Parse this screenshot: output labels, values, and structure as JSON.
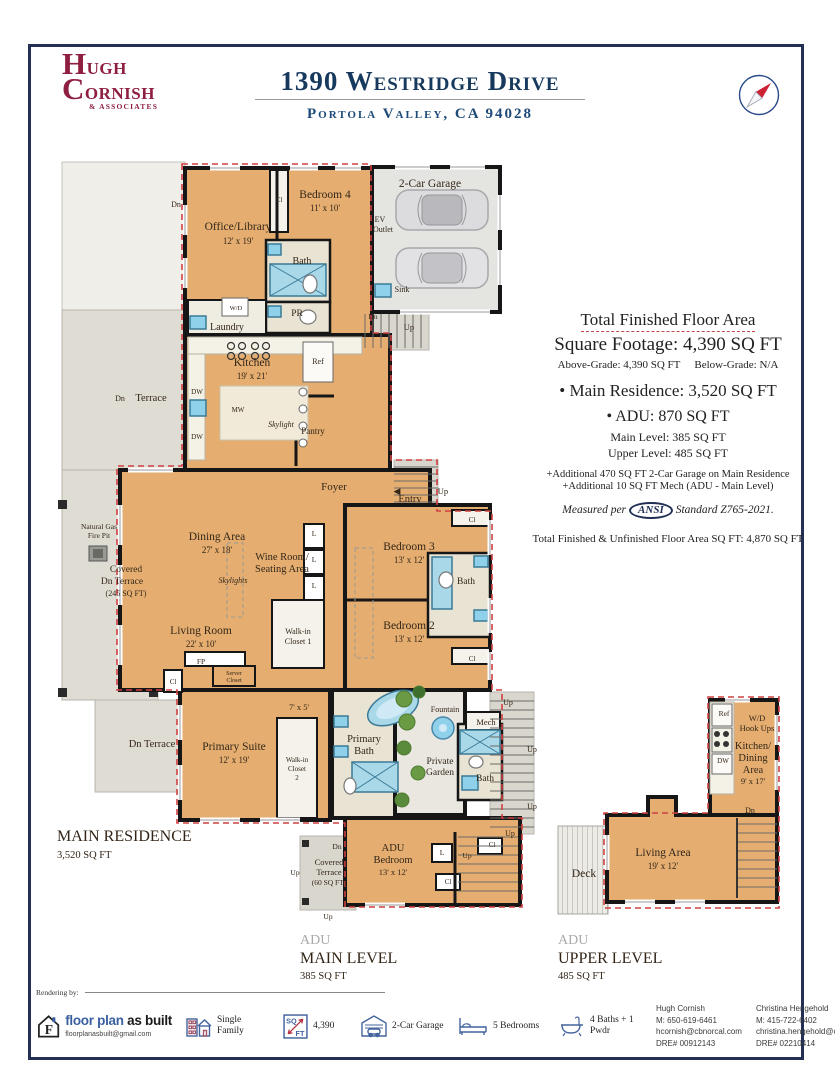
{
  "header": {
    "logo_line1": "HUGH",
    "logo_line2": "CORNISH",
    "logo_line3": "& ASSOCIATES",
    "address": "1390 Westridge Drive",
    "city": "Portola Valley, CA 94028"
  },
  "accent_colors": {
    "navy": "#17395e",
    "maroon": "#8e1f40",
    "red_dash": "#cf4040",
    "floor_tan": "#e5ae70"
  },
  "sqft_block": {
    "total_title": "Total Finished Floor Area",
    "total_sqft": "Square Footage: 4,390 SQ FT",
    "above": "Above-Grade: 4,390 SQ FT",
    "below": "Below-Grade: N/A",
    "main_res": "• Main Residence: 3,520 SQ FT",
    "adu": "• ADU: 870 SQ FT",
    "adu_main": "Main Level: 385 SQ FT",
    "adu_upper": "Upper Level: 485 SQ FT",
    "add1": "+Additional 470 SQ FT 2-Car Garage on Main Residence",
    "add2": "+Additional 10 SQ FT Mech (ADU - Main Level)",
    "measured_pre": "Measured per",
    "ansi": "ANSI",
    "measured_post": "Standard Z765-2021.",
    "total_unfinished": "Total Finished & Unfinished Floor Area SQ FT: 4,870 SQ FT"
  },
  "footer": {
    "rendering_by": "Rendering by:",
    "logo": {
      "brand_blue": "floor plan",
      "brand_black": " as built",
      "email": "floorplanasbuilt@gmail.com"
    },
    "stats": [
      {
        "icon": "building-icon",
        "label": "Single Family"
      },
      {
        "icon": "sqft-icon",
        "label": "4,390"
      },
      {
        "icon": "garage-icon",
        "label": "2-Car Garage"
      },
      {
        "icon": "bed-icon",
        "label": "5 Bedrooms"
      },
      {
        "icon": "bath-icon",
        "label": "4 Baths + 1 Pwdr"
      }
    ],
    "agents": [
      {
        "name": "Hugh Cornish",
        "mobile": "M: 650-619-6461",
        "email": "hcornish@cbnorcal.com",
        "dre": "DRE# 00912143"
      },
      {
        "name": "Christina Hengehold",
        "mobile": "M: 415-722-6402",
        "email": "christina.hengehold@cbrealty.com",
        "dre": "DRE# 02210414"
      }
    ]
  },
  "plan": {
    "texts": [
      {
        "t": "Dn",
        "x": 176,
        "y": 207,
        "s": 8,
        "n": "dn-label-top-left"
      },
      {
        "t": "Office/Library",
        "x": 238,
        "y": 230,
        "s": 11.5,
        "n": "room-office-library"
      },
      {
        "t": "12' x 19'",
        "x": 238,
        "y": 244,
        "s": 9,
        "n": "room-office-dims"
      },
      {
        "t": "Bedroom 4",
        "x": 325,
        "y": 198,
        "s": 11.5,
        "n": "room-bedroom4"
      },
      {
        "t": "11' x 10'",
        "x": 325,
        "y": 211,
        "s": 9,
        "n": "room-bedroom4-dims"
      },
      {
        "t": "Cl",
        "x": 279,
        "y": 202,
        "s": 7,
        "n": "closet-bedroom4"
      },
      {
        "t": "Bath",
        "x": 302,
        "y": 264,
        "s": 10,
        "n": "room-bath-top"
      },
      {
        "t": "PR",
        "x": 297,
        "y": 316,
        "s": 9.5,
        "n": "room-pr"
      },
      {
        "t": "W/D",
        "x": 236,
        "y": 310,
        "s": 6.5,
        "n": "wd-label"
      },
      {
        "t": "Laundry",
        "x": 227,
        "y": 330,
        "s": 10,
        "n": "room-laundry"
      },
      {
        "t": "2-Car Garage",
        "x": 430,
        "y": 187,
        "s": 11.5,
        "n": "room-garage"
      },
      {
        "t": "EV",
        "x": 380,
        "y": 222,
        "s": 8,
        "n": "ev-outlet-1"
      },
      {
        "t": "Outlet",
        "x": 383,
        "y": 232,
        "s": 8,
        "n": "ev-outlet-2"
      },
      {
        "t": "Sink",
        "x": 402,
        "y": 292,
        "s": 8,
        "n": "sink-garage-label"
      },
      {
        "t": "Dn",
        "x": 373,
        "y": 319,
        "s": 7.5,
        "n": "dn-garage"
      },
      {
        "t": "Up",
        "x": 409,
        "y": 330,
        "s": 8.5,
        "n": "up-garage"
      },
      {
        "t": "Kitchen",
        "x": 252,
        "y": 366,
        "s": 11.5,
        "n": "room-kitchen"
      },
      {
        "t": "19' x 21'",
        "x": 252,
        "y": 379,
        "s": 9,
        "n": "room-kitchen-dims"
      },
      {
        "t": "Ref",
        "x": 318,
        "y": 364,
        "s": 8,
        "n": "ref-kitchen"
      },
      {
        "t": "DW",
        "x": 197,
        "y": 394,
        "s": 7,
        "n": "dw-1"
      },
      {
        "t": "MW",
        "x": 238,
        "y": 412,
        "s": 7,
        "n": "mw-label"
      },
      {
        "t": "DW",
        "x": 197,
        "y": 439,
        "s": 7,
        "n": "dw-2"
      },
      {
        "t": "Skylight",
        "x": 281,
        "y": 427,
        "s": 8,
        "i": 1,
        "n": "skylight-kitchen"
      },
      {
        "t": "Pantry",
        "x": 313,
        "y": 434,
        "s": 9,
        "n": "room-pantry"
      },
      {
        "t": "Dn",
        "x": 120,
        "y": 401,
        "s": 8,
        "n": "dn-terrace-mid"
      },
      {
        "t": "Terrace",
        "x": 151,
        "y": 401,
        "s": 10.5,
        "n": "terrace-mid"
      },
      {
        "t": "Foyer",
        "x": 334,
        "y": 490,
        "s": 11,
        "n": "room-foyer"
      },
      {
        "t": "◀",
        "x": 397,
        "y": 494,
        "s": 9,
        "n": "entry-arrow"
      },
      {
        "t": "Entry",
        "x": 410,
        "y": 502,
        "s": 10.5,
        "n": "entry-label"
      },
      {
        "t": "Up",
        "x": 443,
        "y": 494,
        "s": 8.5,
        "n": "up-entry"
      },
      {
        "t": "Dining Area",
        "x": 217,
        "y": 540,
        "s": 11.5,
        "n": "room-dining"
      },
      {
        "t": "27' x 18'",
        "x": 217,
        "y": 553,
        "s": 9,
        "n": "room-dining-dims"
      },
      {
        "t": "Wine Room/",
        "x": 282,
        "y": 560,
        "s": 10.5,
        "n": "room-wine-1"
      },
      {
        "t": "Seating Area",
        "x": 282,
        "y": 572,
        "s": 10.5,
        "n": "room-wine-2"
      },
      {
        "t": "Skylights",
        "x": 233,
        "y": 583,
        "s": 8,
        "i": 1,
        "n": "skylights-dining"
      },
      {
        "t": "Living Room",
        "x": 201,
        "y": 634,
        "s": 11.5,
        "n": "room-living"
      },
      {
        "t": "22' x 10'",
        "x": 201,
        "y": 647,
        "s": 9,
        "n": "room-living-dims"
      },
      {
        "t": "FP",
        "x": 201,
        "y": 664,
        "s": 7.5,
        "n": "fp-label"
      },
      {
        "t": "Cl",
        "x": 173,
        "y": 684,
        "s": 7,
        "n": "closet-living"
      },
      {
        "t": "Server",
        "x": 234,
        "y": 675,
        "s": 6,
        "n": "server-closet-1"
      },
      {
        "t": "Closet",
        "x": 234,
        "y": 682,
        "s": 6,
        "n": "server-closet-2"
      },
      {
        "t": "Walk-in",
        "x": 298,
        "y": 634,
        "s": 8,
        "n": "walkin1-1"
      },
      {
        "t": "Closet 1",
        "x": 298,
        "y": 644,
        "s": 8,
        "n": "walkin1-2"
      },
      {
        "t": "L",
        "x": 314,
        "y": 536,
        "s": 7.5,
        "n": "linen-1"
      },
      {
        "t": "L",
        "x": 314,
        "y": 562,
        "s": 7.5,
        "n": "linen-2"
      },
      {
        "t": "L",
        "x": 314,
        "y": 588,
        "s": 7.5,
        "n": "linen-3"
      },
      {
        "t": "Bedroom 3",
        "x": 409,
        "y": 550,
        "s": 11.5,
        "n": "room-bedroom3"
      },
      {
        "t": "13' x 12'",
        "x": 409,
        "y": 563,
        "s": 9,
        "n": "room-bedroom3-dims"
      },
      {
        "t": "Bedroom 2",
        "x": 409,
        "y": 629,
        "s": 11.5,
        "n": "room-bedroom2"
      },
      {
        "t": "13' x 12'",
        "x": 409,
        "y": 642,
        "s": 9,
        "n": "room-bedroom2-dims"
      },
      {
        "t": "Bath",
        "x": 466,
        "y": 584,
        "s": 9.5,
        "n": "room-bath-beds"
      },
      {
        "t": "Cl",
        "x": 472,
        "y": 522,
        "s": 7,
        "n": "closet-bed3"
      },
      {
        "t": "Cl",
        "x": 472,
        "y": 661,
        "s": 7,
        "n": "closet-bed2"
      },
      {
        "t": "Natural Gas",
        "x": 99,
        "y": 529,
        "s": 7.5,
        "n": "firepit-1"
      },
      {
        "t": "Fire Pit",
        "x": 99,
        "y": 538,
        "s": 7.5,
        "n": "firepit-2"
      },
      {
        "t": "Covered",
        "x": 126,
        "y": 572,
        "s": 9.5,
        "n": "covered-terrace-1"
      },
      {
        "t": "Dn Terrace",
        "x": 122,
        "y": 584,
        "s": 9.5,
        "n": "covered-terrace-2"
      },
      {
        "t": "(245 SQ FT)",
        "x": 126,
        "y": 596,
        "s": 8,
        "n": "covered-terrace-3"
      },
      {
        "t": "Primary Suite",
        "x": 234,
        "y": 750,
        "s": 11.5,
        "n": "room-primary"
      },
      {
        "t": "12' x 19'",
        "x": 234,
        "y": 763,
        "s": 9,
        "n": "room-primary-dims"
      },
      {
        "t": "7' x 5'",
        "x": 299,
        "y": 710,
        "s": 8.5,
        "n": "hall-dims"
      },
      {
        "t": "Walk-in",
        "x": 297,
        "y": 762,
        "s": 7,
        "n": "walkin2-1"
      },
      {
        "t": "Closet",
        "x": 297,
        "y": 771,
        "s": 7,
        "n": "walkin2-2"
      },
      {
        "t": "2",
        "x": 297,
        "y": 780,
        "s": 7,
        "n": "walkin2-3"
      },
      {
        "t": "Primary",
        "x": 364,
        "y": 742,
        "s": 10.5,
        "n": "room-pbath-1"
      },
      {
        "t": "Bath",
        "x": 364,
        "y": 754,
        "s": 10.5,
        "n": "room-pbath-2"
      },
      {
        "t": "Dn Terrace",
        "x": 152,
        "y": 747,
        "s": 10.5,
        "n": "dn-terrace-lower"
      },
      {
        "t": "Fountain",
        "x": 445,
        "y": 712,
        "s": 8,
        "n": "fountain-label"
      },
      {
        "t": "Private",
        "x": 440,
        "y": 764,
        "s": 9.5,
        "n": "private-garden-1"
      },
      {
        "t": "Garden",
        "x": 440,
        "y": 775,
        "s": 9.5,
        "n": "private-garden-2"
      },
      {
        "t": "Mech",
        "x": 486,
        "y": 725,
        "s": 8.5,
        "n": "mech-label"
      },
      {
        "t": "Bath",
        "x": 485,
        "y": 781,
        "s": 9.5,
        "n": "room-bath-adu-main"
      },
      {
        "t": "Up",
        "x": 508,
        "y": 705,
        "s": 8,
        "n": "up-right-1"
      },
      {
        "t": "Up",
        "x": 532,
        "y": 752,
        "s": 8,
        "n": "up-right-2"
      },
      {
        "t": "Up",
        "x": 532,
        "y": 809,
        "s": 8,
        "n": "up-right-3"
      },
      {
        "t": "Up",
        "x": 510,
        "y": 836,
        "s": 8,
        "n": "up-right-4"
      },
      {
        "t": "MAIN RESIDENCE",
        "x": 57,
        "y": 841,
        "s": 16,
        "a": "s",
        "n": "main-residence-title"
      },
      {
        "t": "3,520 SQ FT",
        "x": 57,
        "y": 858,
        "s": 10.5,
        "a": "s",
        "n": "main-residence-sqft"
      },
      {
        "t": "ADU",
        "x": 393,
        "y": 851,
        "s": 10.5,
        "n": "room-adu-bed-1"
      },
      {
        "t": "Bedroom",
        "x": 393,
        "y": 863,
        "s": 10.5,
        "n": "room-adu-bed-2"
      },
      {
        "t": "13' x 12'",
        "x": 393,
        "y": 875,
        "s": 8.5,
        "n": "room-adu-bed-dims"
      },
      {
        "t": "L",
        "x": 442,
        "y": 855,
        "s": 7.5,
        "n": "linen-adu"
      },
      {
        "t": "Up",
        "x": 467,
        "y": 858,
        "s": 7.5,
        "n": "up-adu-inner"
      },
      {
        "t": "Cl",
        "x": 492,
        "y": 847,
        "s": 7,
        "n": "closet-adu-1"
      },
      {
        "t": "Cl",
        "x": 448,
        "y": 884,
        "s": 7,
        "n": "closet-adu-2"
      },
      {
        "t": "Dn",
        "x": 337,
        "y": 849,
        "s": 7.5,
        "n": "dn-adu-terrace"
      },
      {
        "t": "Covered",
        "x": 329,
        "y": 865,
        "s": 8.5,
        "n": "adu-terrace-1"
      },
      {
        "t": "Terrace",
        "x": 329,
        "y": 875,
        "s": 8.5,
        "n": "adu-terrace-2"
      },
      {
        "t": "(60 SQ FT)",
        "x": 329,
        "y": 885,
        "s": 7.5,
        "n": "adu-terrace-3"
      },
      {
        "t": "Up",
        "x": 295,
        "y": 875,
        "s": 7.5,
        "n": "up-adu-left"
      },
      {
        "t": "Up",
        "x": 328,
        "y": 919,
        "s": 7.5,
        "n": "up-adu-bottom"
      },
      {
        "t": "ADU",
        "x": 300,
        "y": 944,
        "s": 14,
        "a": "s",
        "c": "#aaaaaa",
        "n": "adu-main-title-gray"
      },
      {
        "t": "MAIN LEVEL",
        "x": 300,
        "y": 963,
        "s": 16,
        "a": "s",
        "n": "adu-main-title"
      },
      {
        "t": "385 SQ FT",
        "x": 300,
        "y": 979,
        "s": 10.5,
        "a": "s",
        "n": "adu-main-sqft"
      },
      {
        "t": "Ref",
        "x": 724,
        "y": 716,
        "s": 7.5,
        "n": "ref-adu"
      },
      {
        "t": "W/D",
        "x": 757,
        "y": 721,
        "s": 8.5,
        "n": "adu-wd-1"
      },
      {
        "t": "Hook Ups",
        "x": 757,
        "y": 731,
        "s": 8.5,
        "n": "adu-wd-2"
      },
      {
        "t": "DW",
        "x": 723,
        "y": 763,
        "s": 7,
        "n": "dw-adu"
      },
      {
        "t": "Kitchen/",
        "x": 753,
        "y": 749,
        "s": 10.5,
        "n": "room-adu-kitchen-1"
      },
      {
        "t": "Dining",
        "x": 753,
        "y": 761,
        "s": 10.5,
        "n": "room-adu-kitchen-2"
      },
      {
        "t": "Area",
        "x": 753,
        "y": 773,
        "s": 10.5,
        "n": "room-adu-kitchen-3"
      },
      {
        "t": "9' x 17'",
        "x": 753,
        "y": 784,
        "s": 8.5,
        "n": "room-adu-kitchen-dims"
      },
      {
        "t": "Dn",
        "x": 750,
        "y": 813,
        "s": 8,
        "n": "dn-adu-upper"
      },
      {
        "t": "Living Area",
        "x": 663,
        "y": 856,
        "s": 11.5,
        "n": "room-adu-living"
      },
      {
        "t": "19' x 12'",
        "x": 663,
        "y": 869,
        "s": 9,
        "n": "room-adu-living-dims"
      },
      {
        "t": "Deck",
        "x": 584,
        "y": 877,
        "s": 11.5,
        "n": "deck-label"
      },
      {
        "t": "ADU",
        "x": 558,
        "y": 944,
        "s": 14,
        "a": "s",
        "c": "#aaaaaa",
        "n": "adu-upper-title-gray"
      },
      {
        "t": "UPPER LEVEL",
        "x": 558,
        "y": 963,
        "s": 16,
        "a": "s",
        "n": "adu-upper-title"
      },
      {
        "t": "485 SQ FT",
        "x": 558,
        "y": 979,
        "s": 10.5,
        "a": "s",
        "n": "adu-upper-sqft"
      }
    ]
  }
}
